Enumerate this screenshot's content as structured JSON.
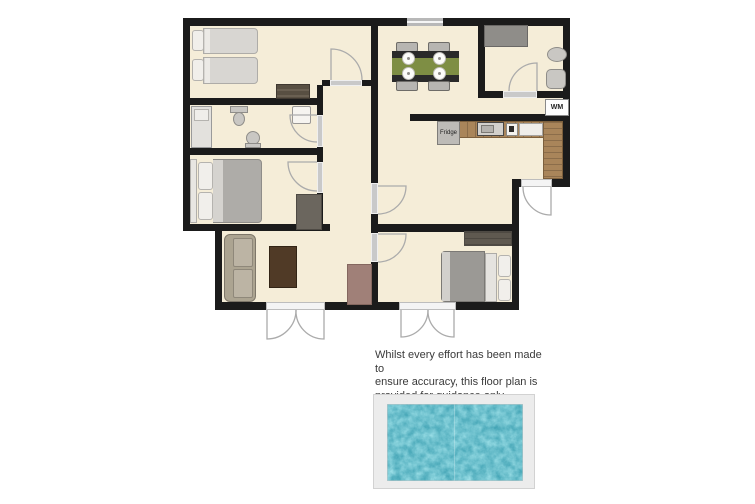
{
  "floor_plan": {
    "labels": {
      "washing_machine": "WM",
      "fridge": "Fridge"
    },
    "rooms": [
      "twin-bedroom",
      "bathroom",
      "double-bedroom",
      "hallway",
      "living-room",
      "kitchen-diner",
      "shower-room",
      "double-bedroom-2"
    ],
    "furniture": [
      "single-bed",
      "single-bed",
      "dresser",
      "shower",
      "toilet",
      "bidet",
      "basin",
      "double-bed",
      "wardrobe",
      "sofa",
      "coffee-table",
      "sideboard",
      "dining-table",
      "dining-chairs",
      "fridge",
      "sink-unit",
      "hob",
      "worktop",
      "washing-machine",
      "shower-enclosure",
      "basin",
      "toilet",
      "wardrobe",
      "double-bed",
      "swimming-pool"
    ]
  },
  "disclaimer": {
    "line1": "Whilst every effort has been made to",
    "line2": "ensure accuracy, this floor plan is",
    "line3": "provided for guidance only"
  },
  "colors": {
    "floor": "#f5edd8",
    "wall": "#1b1b1b",
    "threshold": "#c9c9c9",
    "window": "#b8b8b8",
    "doorarc": "#ababab",
    "pooldeck": "#ececec",
    "poolbase": "#2e96a9",
    "poollight": "#5cc4d3",
    "textcol": "#3a3a3a",
    "counter": "#a9855a"
  }
}
